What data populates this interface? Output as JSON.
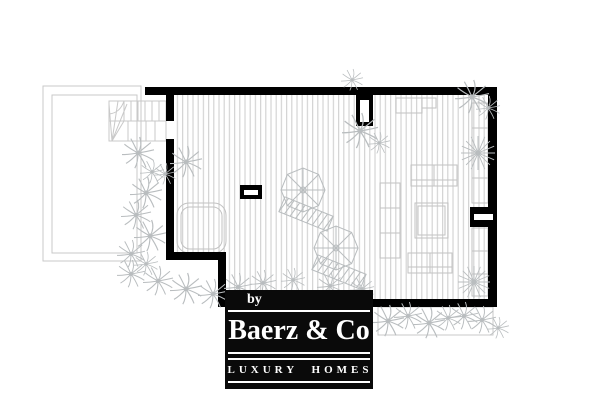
{
  "meta": {
    "description": "Black and white architectural floor plan of a roof terrace with decking, stairs, jacuzzi, lounge furniture, parasols and palm planting; real-estate watermark logo bottom centre.",
    "width_px": 600,
    "height_px": 401
  },
  "logo": {
    "by": "by",
    "name": "Baerz & Co",
    "tagline": "LUXURY HOMES",
    "background": "#0a0a0a",
    "text_color": "#ffffff"
  },
  "colors": {
    "background": "#ffffff",
    "wall": "#000000",
    "deck_stripe": "#d4d4d4",
    "furniture_outline": "#c2c2c2",
    "faint_outline": "#c9c9c9",
    "plant": "#b9bdbf"
  },
  "plan": {
    "elements": [
      "deck-boards",
      "perimeter-walls",
      "staircase",
      "adjacent-terrace-outline",
      "lower-terrace-outline",
      "jacuzzi",
      "sideboard",
      "wall-bench-upper",
      "wall-bench-lower",
      "sofa-top",
      "sofa-bottom",
      "chaise-left",
      "coffee-table",
      "parasol-symbols",
      "palm-plants",
      "starburst-plants",
      "door-symbol-top",
      "window-symbol-right",
      "floor-marker"
    ],
    "plants": {
      "palm": [
        [
          138,
          153,
          0.8
        ],
        [
          152,
          172,
          0.6
        ],
        [
          146,
          193,
          0.8
        ],
        [
          136,
          215,
          0.75
        ],
        [
          150,
          236,
          0.8
        ],
        [
          131,
          254,
          0.7
        ],
        [
          146,
          264,
          0.6
        ],
        [
          131,
          274,
          0.7
        ],
        [
          158,
          281,
          0.75
        ],
        [
          186,
          289,
          0.8
        ],
        [
          213,
          294,
          0.75
        ],
        [
          238,
          287,
          0.7
        ],
        [
          186,
          162,
          0.8
        ],
        [
          165,
          174,
          0.55
        ],
        [
          352,
          80,
          0.55
        ],
        [
          360,
          131,
          0.9
        ],
        [
          379,
          143,
          0.55
        ],
        [
          472,
          97,
          0.85
        ],
        [
          488,
          108,
          0.6
        ],
        [
          263,
          283,
          0.65
        ],
        [
          293,
          280,
          0.6
        ],
        [
          330,
          286,
          0.65
        ],
        [
          362,
          289,
          0.6
        ],
        [
          388,
          321,
          0.8
        ],
        [
          408,
          316,
          0.7
        ],
        [
          429,
          323,
          0.8
        ],
        [
          448,
          318,
          0.65
        ],
        [
          464,
          316,
          0.7
        ],
        [
          482,
          320,
          0.7
        ],
        [
          498,
          328,
          0.55
        ]
      ],
      "star": [
        [
          478,
          153,
          0.85
        ],
        [
          474,
          282,
          0.8
        ]
      ],
      "parasol": [
        [
          303,
          190
        ],
        [
          336,
          248
        ]
      ]
    }
  }
}
